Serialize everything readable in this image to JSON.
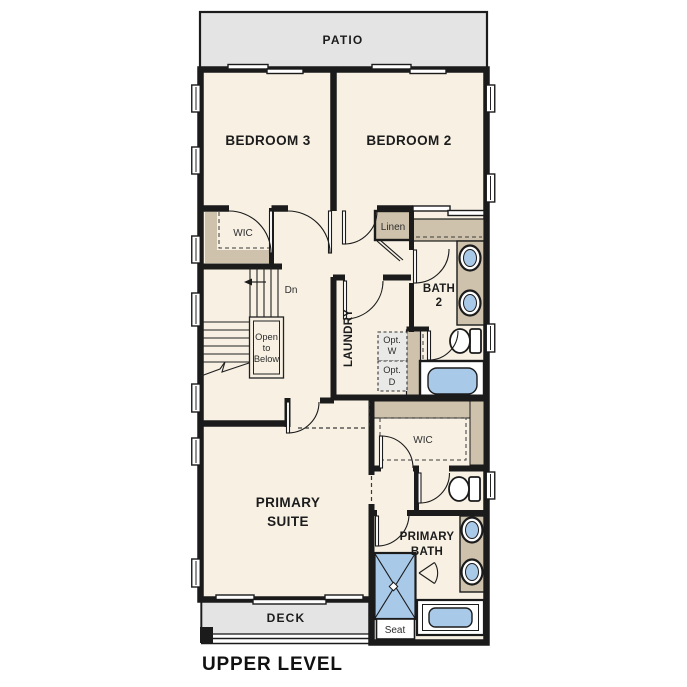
{
  "title": "UPPER LEVEL",
  "outdoor": {
    "patio": "PATIO",
    "deck": "DECK"
  },
  "rooms": {
    "bedroom3": "BEDROOM 3",
    "bedroom2": "BEDROOM 2",
    "hall_wic": "WIC",
    "linen": "Linen",
    "bath2": {
      "l1": "BATH",
      "l2": "2"
    },
    "laundry": "LAUNDRY",
    "primary_suite": {
      "l1": "PRIMARY",
      "l2": "SUITE"
    },
    "primary_wic": "WIC",
    "primary_bath": {
      "l1": "PRIMARY",
      "l2": "BATH"
    }
  },
  "annotations": {
    "dn": "Dn",
    "open_to_below": {
      "l1": "Open",
      "l2": "to",
      "l3": "Below"
    },
    "opt_washer": {
      "l1": "Opt.",
      "l2": "W"
    },
    "opt_dryer": {
      "l1": "Opt.",
      "l2": "D"
    },
    "seat": "Seat"
  },
  "colors": {
    "wall": "#1b1b1b",
    "floor": "#f7f0e3",
    "outdoor_surface": "#e4e4e4",
    "casework": "#cec2ac",
    "fixture_blue": "#a8c9e8",
    "appliance_gray": "#e9e9e7"
  }
}
